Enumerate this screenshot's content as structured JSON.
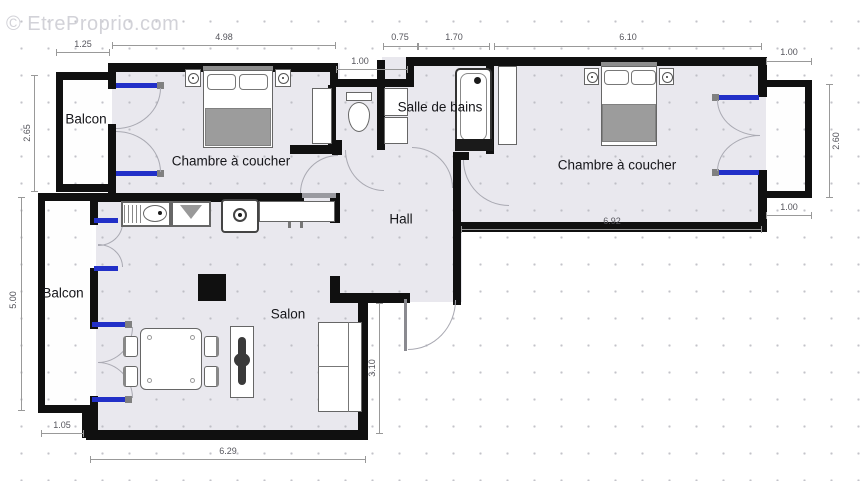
{
  "watermark": "© EtreProprio.com",
  "rooms": {
    "balcony_top": {
      "label": "Balcon"
    },
    "balcony_bottom": {
      "label": "Balcon"
    },
    "bedroom_left": {
      "label": "Chambre à coucher"
    },
    "bedroom_right": {
      "label": "Chambre à coucher"
    },
    "bathroom": {
      "label": "Salle de bains"
    },
    "hall": {
      "label": "Hall"
    },
    "living": {
      "label": "Salon"
    }
  },
  "dimensions": {
    "balcony_top_width": {
      "label": "1.25"
    },
    "bedroom_left_width": {
      "label": "4.98"
    },
    "wc_width": {
      "label": "1.00"
    },
    "bath_niche_width": {
      "label": "0.75"
    },
    "bath_width": {
      "label": "1.70"
    },
    "bedroom_right_width": {
      "label": "6.10"
    },
    "balcony_right_top": {
      "label": "1.00"
    },
    "balcony_right_height": {
      "label": "2.60"
    },
    "balcony_right_bottom": {
      "label": "1.00"
    },
    "bedroom_right_inner": {
      "label": "6.92"
    },
    "balcony_top_height": {
      "label": "2.65"
    },
    "balcony_bottom_height": {
      "label": "5.00"
    },
    "balcony_bottom_width": {
      "label": "1.05"
    },
    "living_width": {
      "label": "6.29"
    },
    "living_height": {
      "label": "3.10"
    }
  },
  "colors": {
    "wall": "#101010",
    "window_door": "#2230c8",
    "room_fill": "#e9e8ee",
    "balcony_fill": "#fefefe",
    "blanket": "#9c9c9c",
    "dimension": "#999999"
  }
}
